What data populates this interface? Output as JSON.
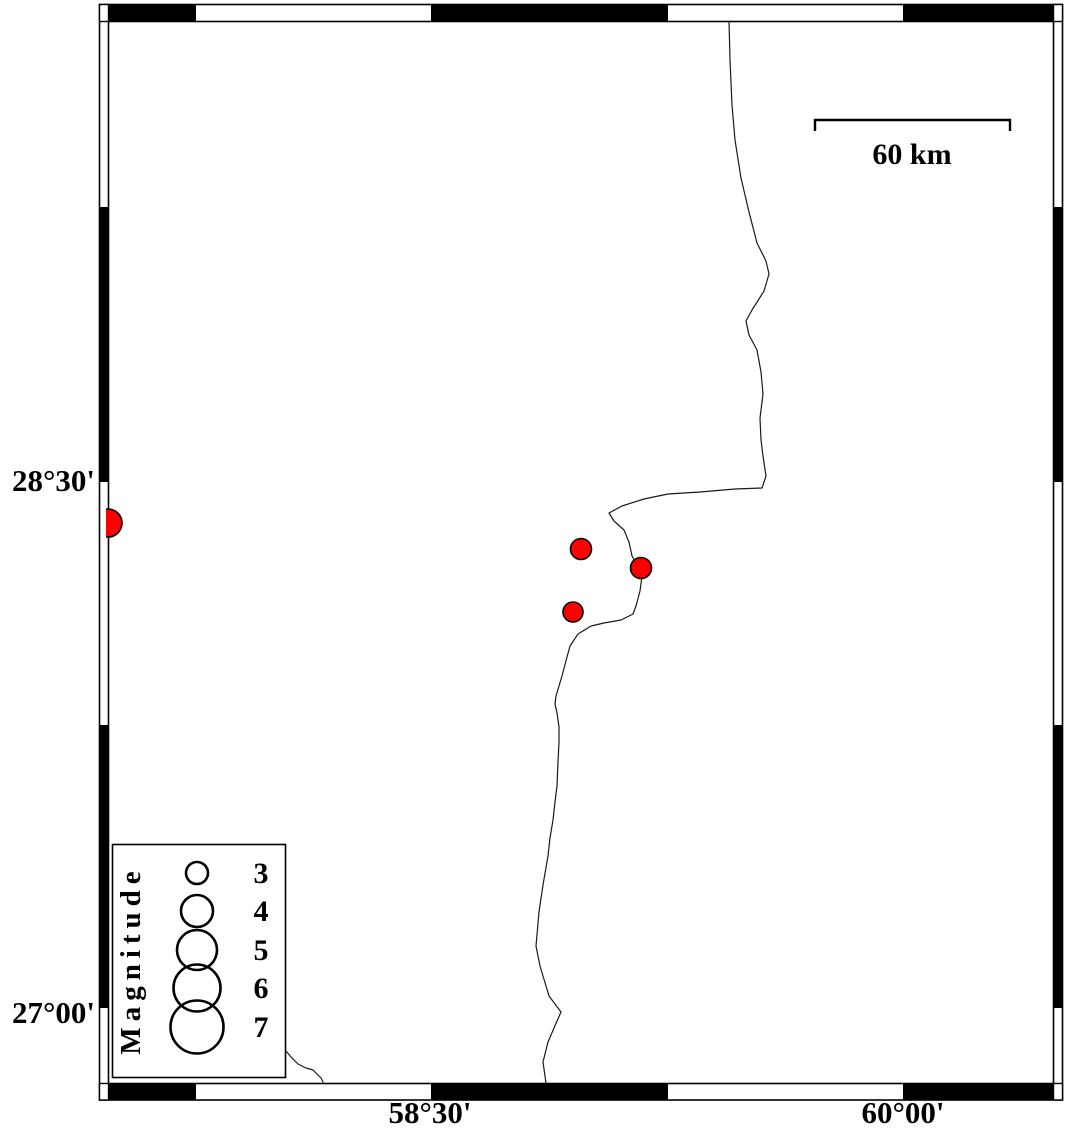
{
  "map": {
    "kind": "earthquake-epicenter-map",
    "frame": {
      "left_labels": [
        {
          "text": "28°30'"
        },
        {
          "text": "27°00'"
        }
      ],
      "bottom_labels": [
        {
          "text": "58°30'"
        },
        {
          "text": "60°00'"
        }
      ]
    },
    "scale_bar": {
      "label": "60 km"
    },
    "legend": {
      "title": "Magnitude",
      "magnitudes": [
        {
          "label": "3",
          "cy": 873,
          "r": 11
        },
        {
          "label": "4",
          "cy": 911,
          "r": 16
        },
        {
          "label": "5",
          "cy": 950,
          "r": 20
        },
        {
          "label": "6",
          "cy": 988,
          "r": 23.5
        },
        {
          "label": "7",
          "cy": 1027,
          "r": 26.5
        }
      ]
    },
    "epicenters": [
      {
        "x": 108,
        "y": 523,
        "r": 14
      },
      {
        "x": 581,
        "y": 549,
        "r": 10.5
      },
      {
        "x": 641,
        "y": 568,
        "r": 10.5
      },
      {
        "x": 573,
        "y": 612,
        "r": 10
      }
    ],
    "colors": {
      "epicenter_fill": "#ff0000",
      "line": "#000000",
      "background": "#ffffff"
    }
  }
}
